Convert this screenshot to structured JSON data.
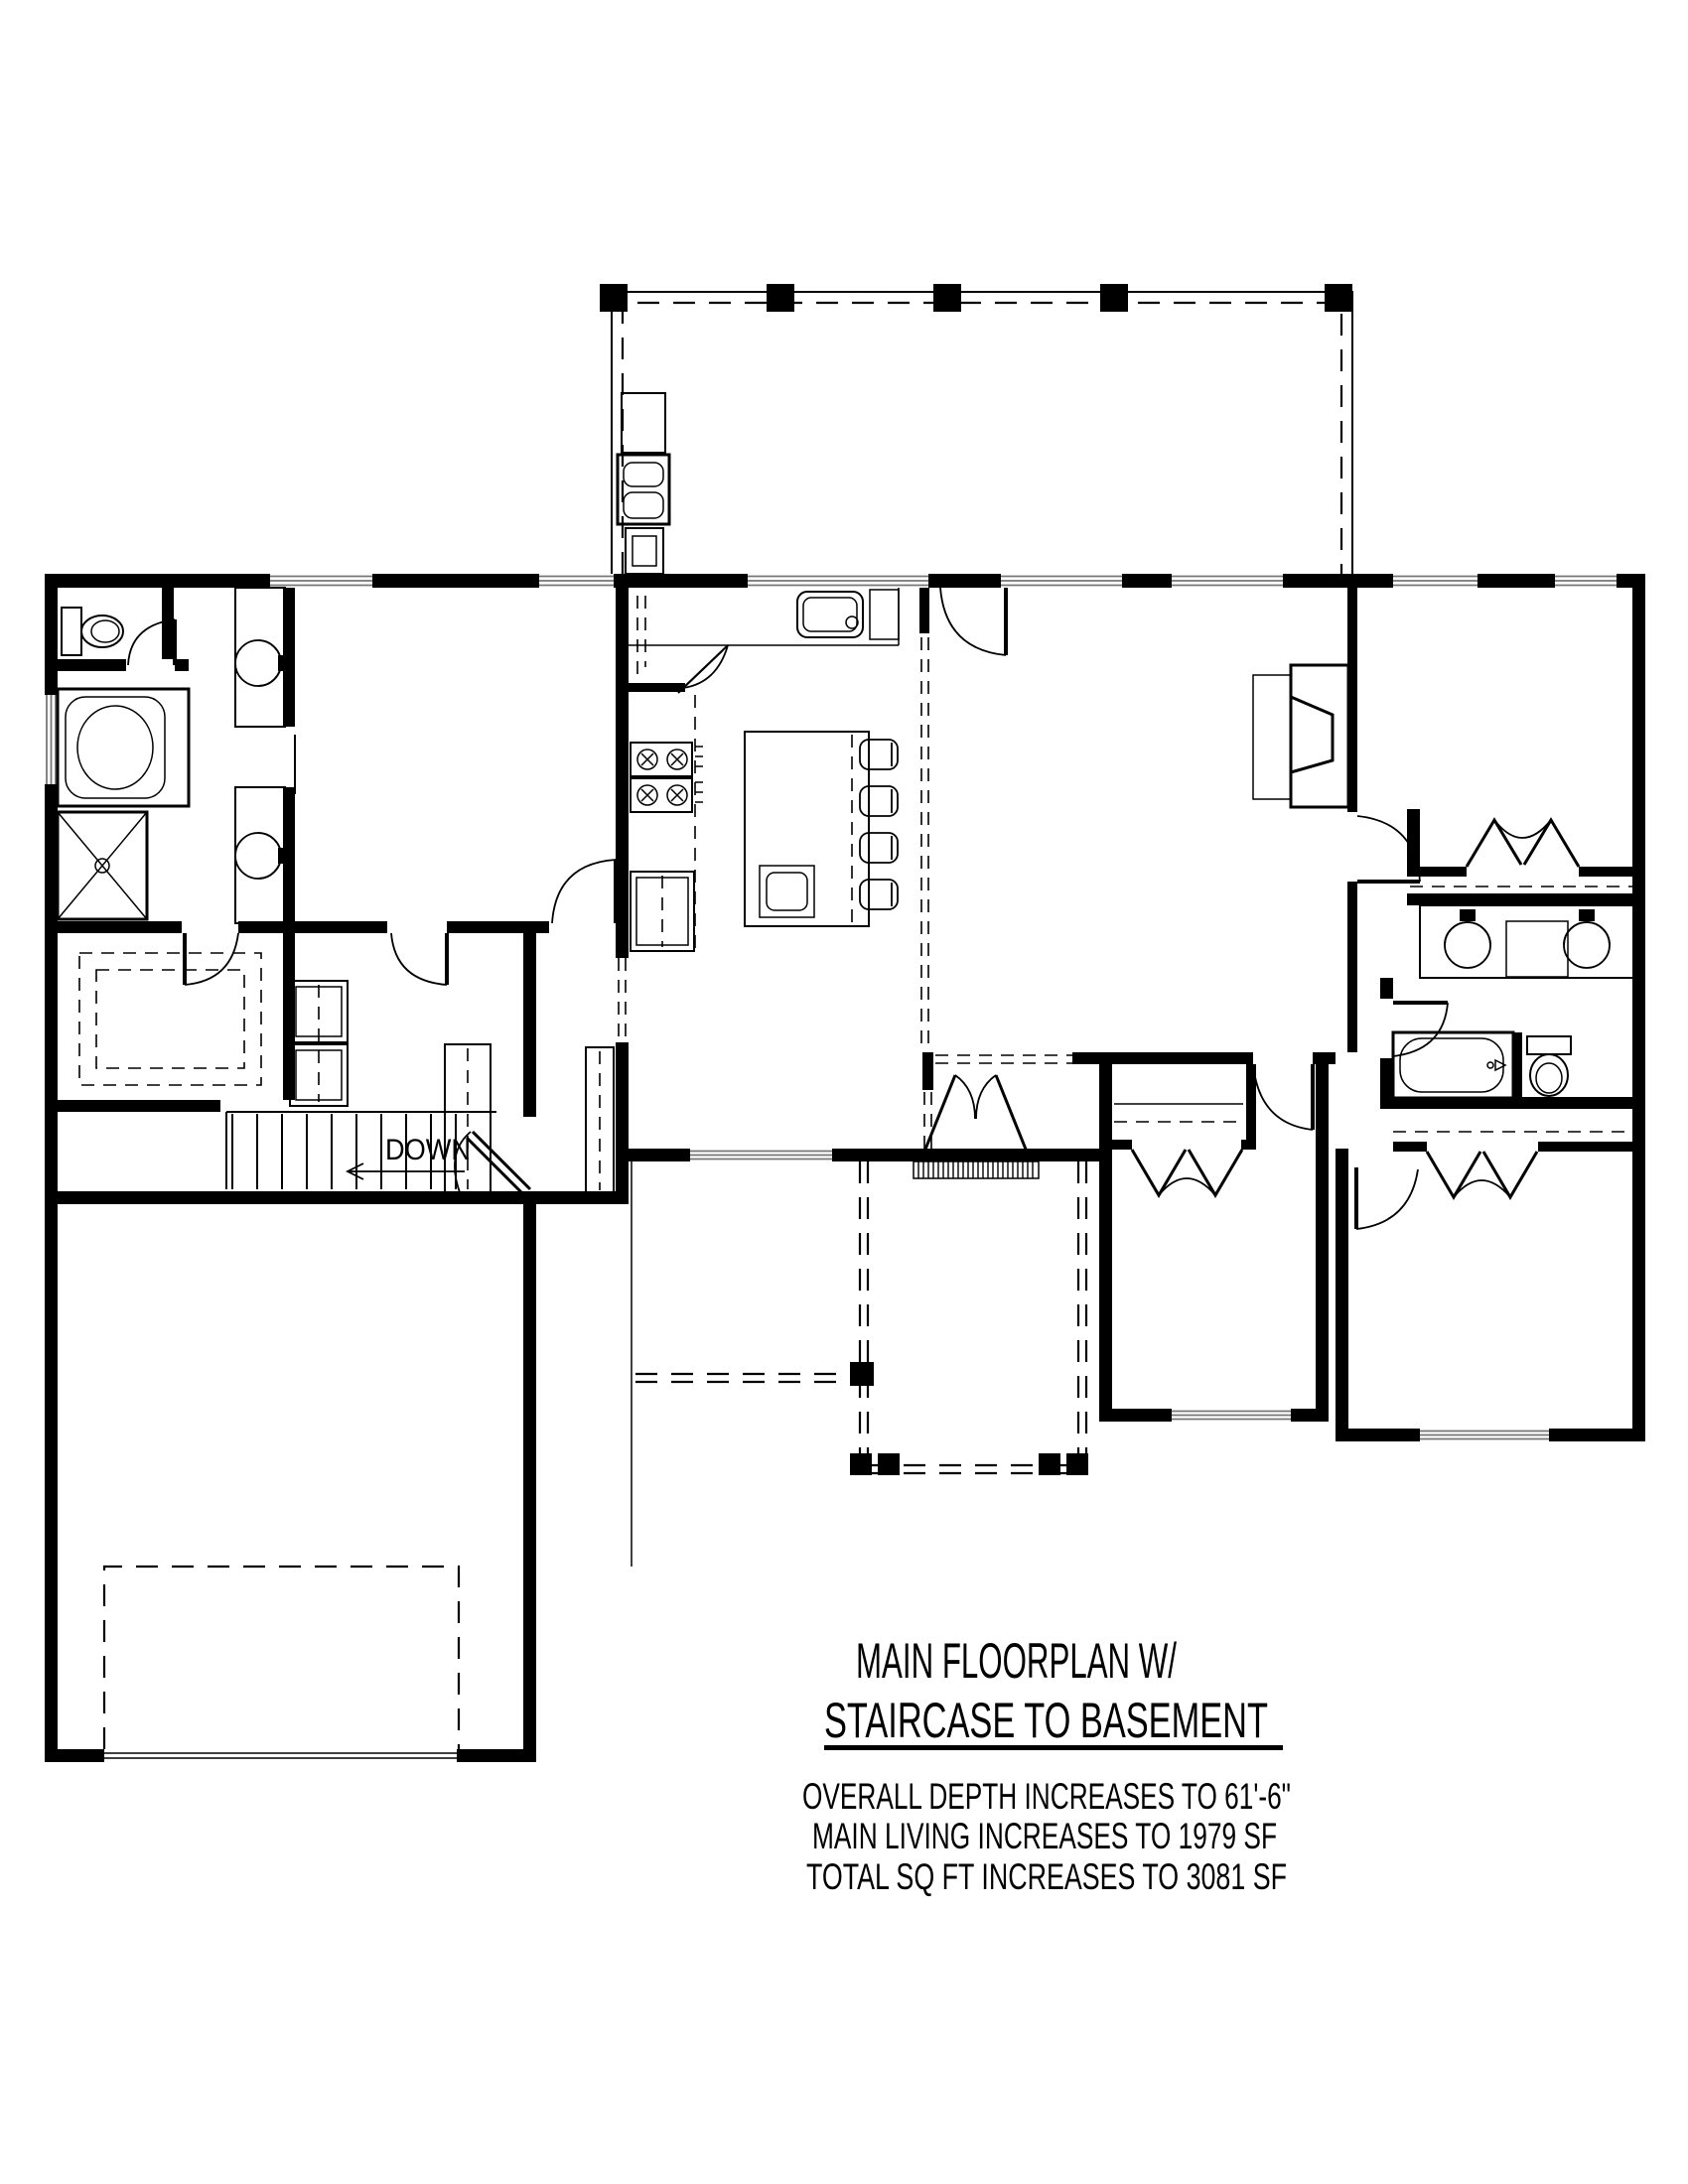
{
  "title": {
    "line1": "MAIN FLOORPLAN W/",
    "line2": "STAIRCASE TO BASEMENT"
  },
  "notes": [
    "OVERALL DEPTH INCREASES TO 61'-6\"",
    "MAIN LIVING INCREASES TO 1979 SF",
    "TOTAL SQ FT INCREASES TO 3081 SF"
  ],
  "plan": {
    "stair_direction_label": "DOWN"
  },
  "colors": {
    "wall": "#000000",
    "background": "#ffffff",
    "window_line": "#767676",
    "text": "#000000"
  },
  "icons": [
    "toilet-icon",
    "bathtub-icon",
    "shower-icon",
    "vanity-sink-icon",
    "kitchen-sink-icon",
    "range-icon",
    "refrigerator-icon",
    "washer-dryer-icon",
    "kitchen-island-icon",
    "bar-stool-icon",
    "fireplace-icon",
    "grill-icon",
    "bifold-closet-door-icon",
    "door-swing-icon",
    "stairs-icon",
    "down-arrow-icon",
    "deck-post-icon",
    "porch-post-icon",
    "garage-door-icon",
    "window-icon"
  ]
}
